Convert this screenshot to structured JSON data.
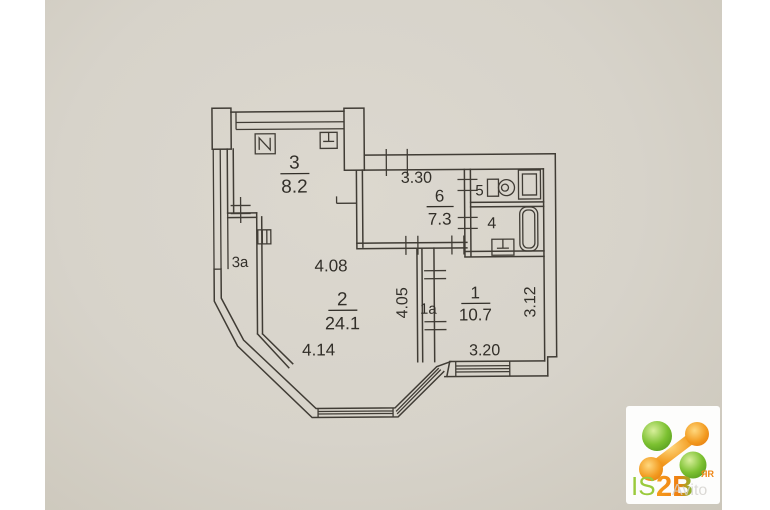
{
  "photo": {
    "paper_color": "#d8d4cb",
    "ink_color": "#403c35"
  },
  "floorplan": {
    "rooms": {
      "kitchen": {
        "number": "3",
        "area": "8.2"
      },
      "balcony": {
        "number": "3a"
      },
      "hall": {
        "number": "6",
        "area": "7.3"
      },
      "wc": {
        "number": "5"
      },
      "bathroom": {
        "number": "4"
      },
      "room1": {
        "number": "1",
        "area": "10.7"
      },
      "closet": {
        "number": "1a"
      },
      "living": {
        "number": "2",
        "area": "24.1"
      }
    },
    "dimensions": {
      "hall_width": "3.30",
      "living_top": "4.08",
      "closet_height": "4.05",
      "room1_height": "3.12",
      "living_bottom": "4.14",
      "room1_width": "3.20"
    },
    "fixtures": [
      "stove-icon",
      "sink-icon",
      "toilet-icon",
      "bathtub-icon",
      "washbasin-icon",
      "vent-cross-icon"
    ]
  },
  "logo": {
    "text_is": "IS",
    "text_2b": "2B",
    "text_small": "ЯR",
    "watermark": "Avito",
    "green": "#7cc131",
    "orange": "#ee8514"
  }
}
